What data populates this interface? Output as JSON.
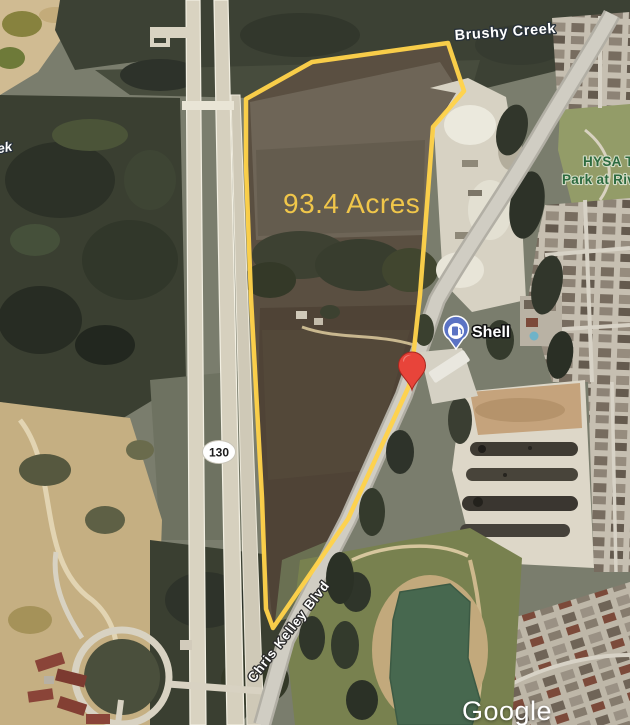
{
  "map": {
    "type": "satellite-aerial-listing-map",
    "attribution": "Google",
    "parcel": {
      "acreage_label": "93.4 Acres",
      "acres_value": 93.4,
      "outline_color": "#FFD24A"
    },
    "labels": {
      "creek_top": "Brushy Creek",
      "creek_left_partial": "ek",
      "park_line1": "HYSA T",
      "park_line2": "Park at Riv",
      "gas_station": "Shell",
      "highway_shield": "130",
      "road_name": "Chris Kelley Blvd"
    },
    "markers": {
      "red_marker": "property-location",
      "poi_pin": "shell-gas-station"
    },
    "colors": {
      "parcel_outline": "#FFD24A",
      "acreage_text": "#F0C64A",
      "red_marker": "#E8443A",
      "poi_pin_blue": "#5B73C4",
      "park_label_green": "#2D6A3F",
      "pond_green": "#47684F"
    }
  }
}
